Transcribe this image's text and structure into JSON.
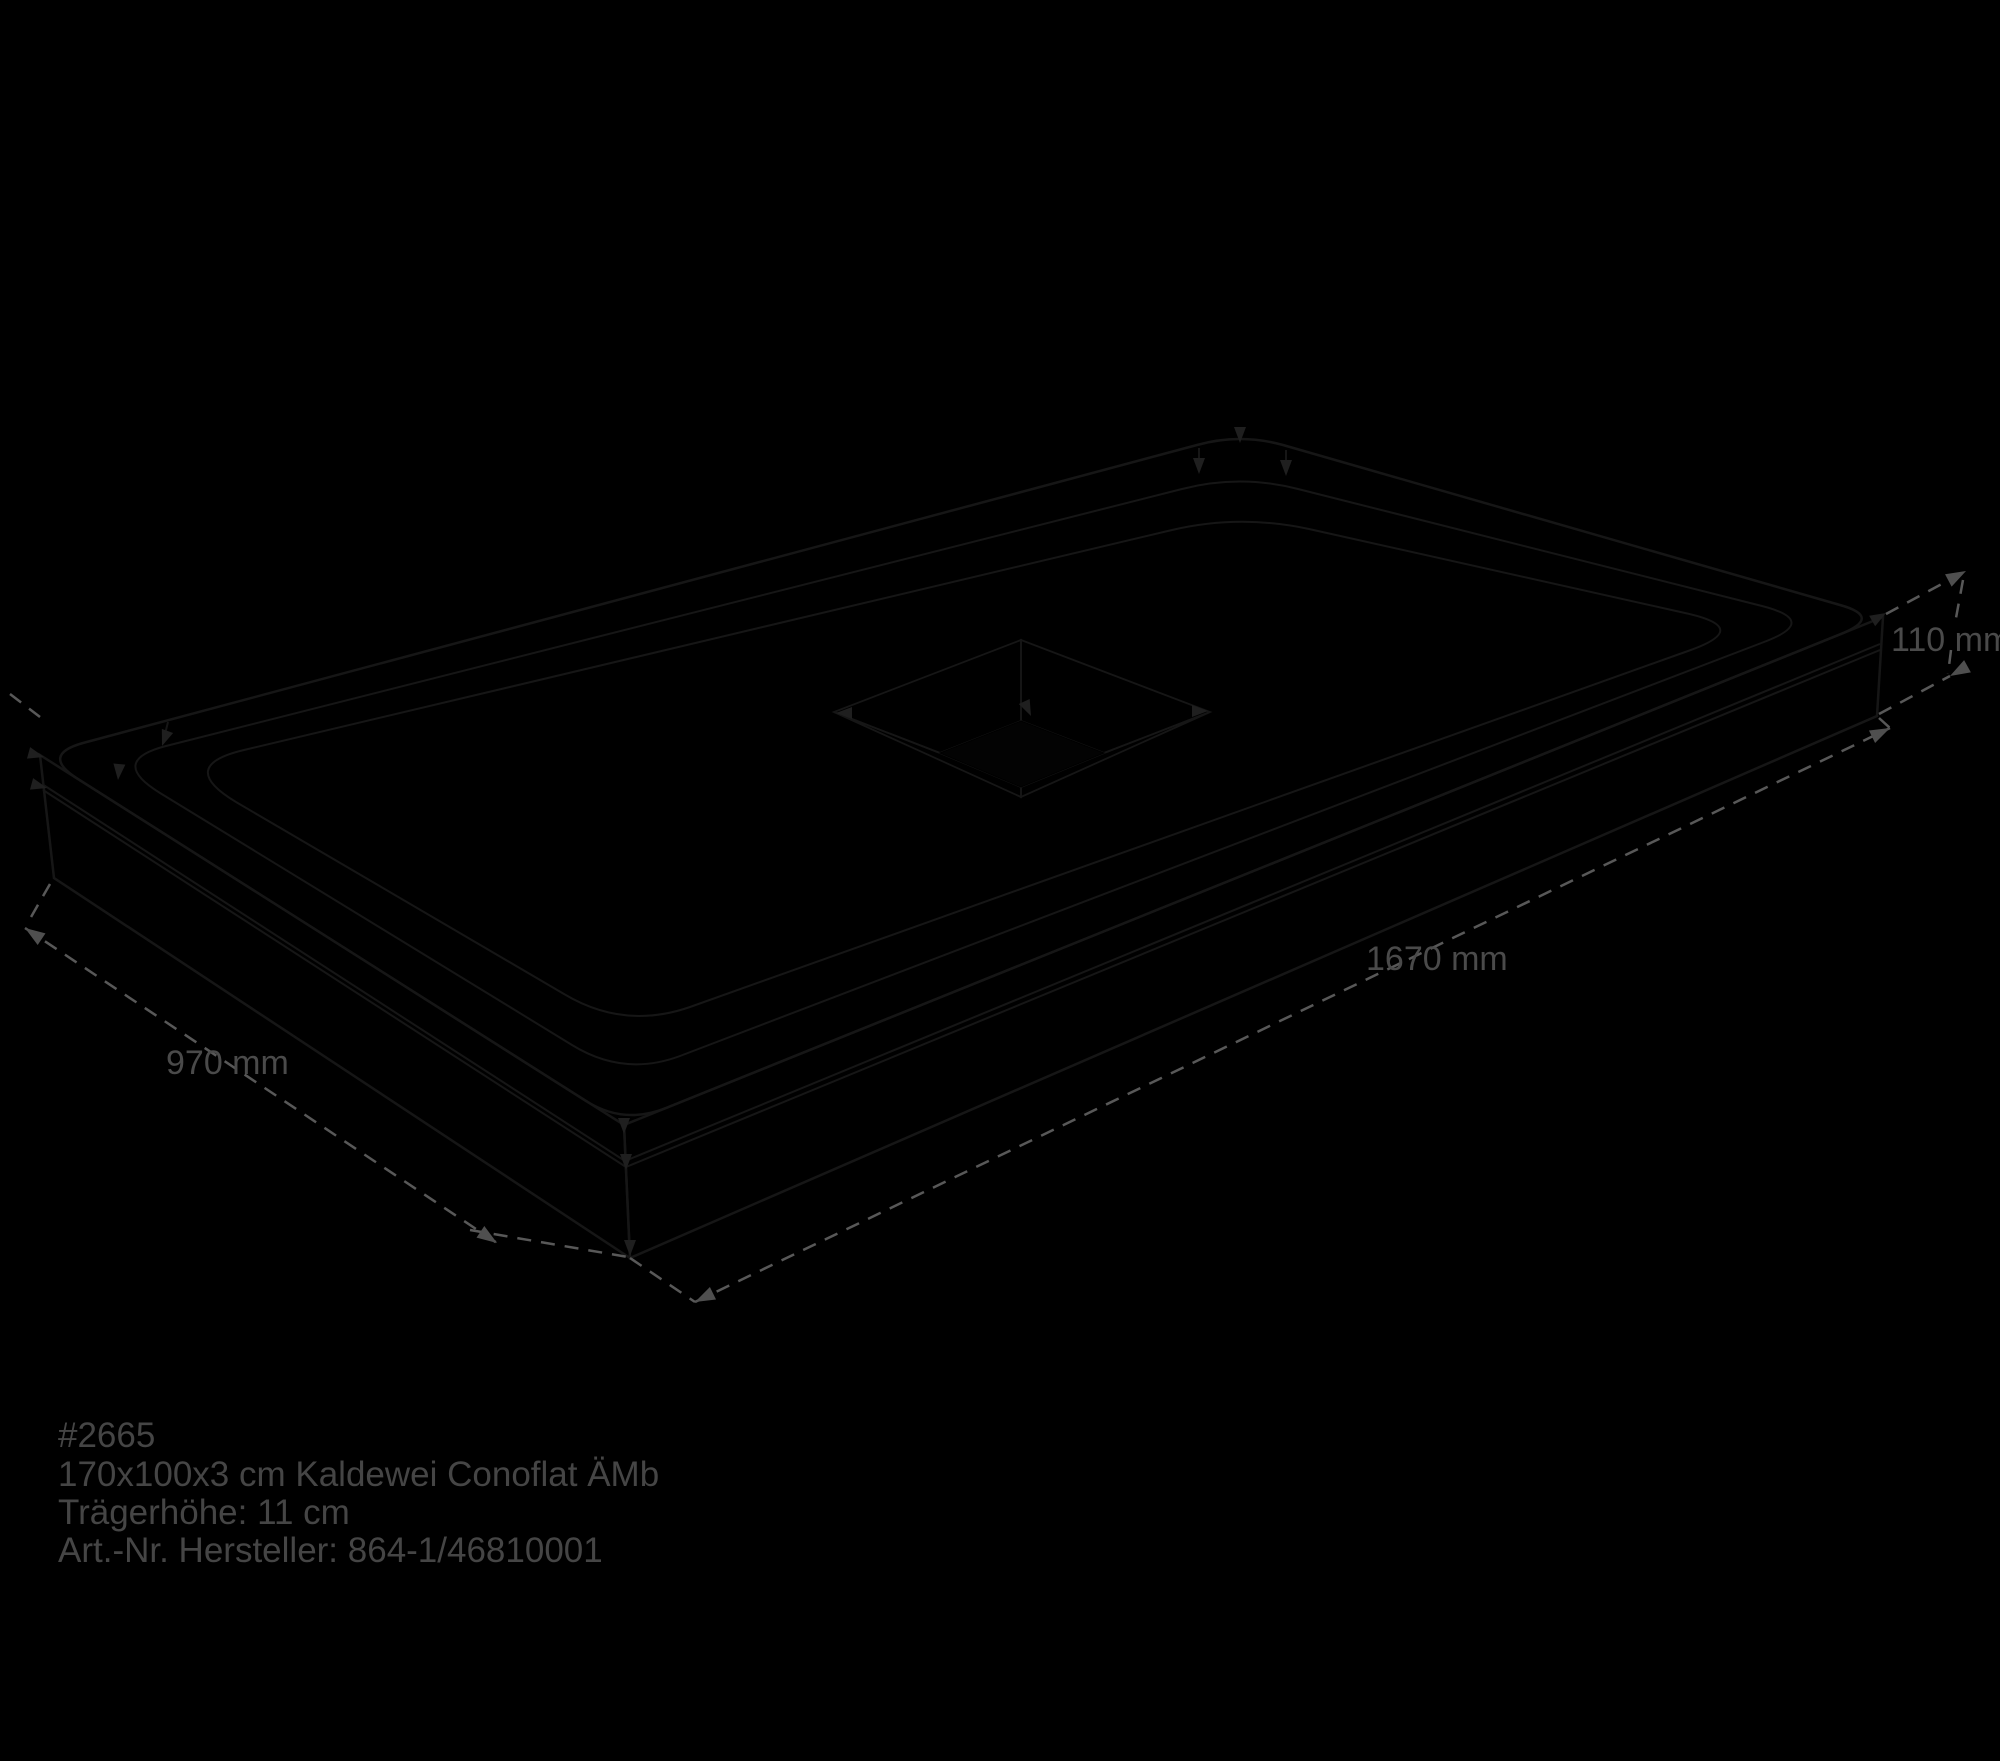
{
  "dims": {
    "length_label": "1670 mm",
    "width_label": "970 mm",
    "height_label": "110 mm"
  },
  "footer": {
    "sku": "#2665",
    "product": "170x100x3 cm Kaldewei Conoflat ÄMb",
    "carrier_height": "Trägerhöhe: 11 cm",
    "article_no": "Art.-Nr. Hersteller: 864-1/46810001"
  },
  "colors": {
    "background": "#000000",
    "bevel_top": "#c8c9ca",
    "rim_wall": "#f9f9f9",
    "floor": "#bfbfbf",
    "side_left": "#ececec",
    "side_right": "#f5f5f5",
    "outline": "#161616",
    "dimension_line": "#585858",
    "dimension_text": "#4a4a4a"
  }
}
